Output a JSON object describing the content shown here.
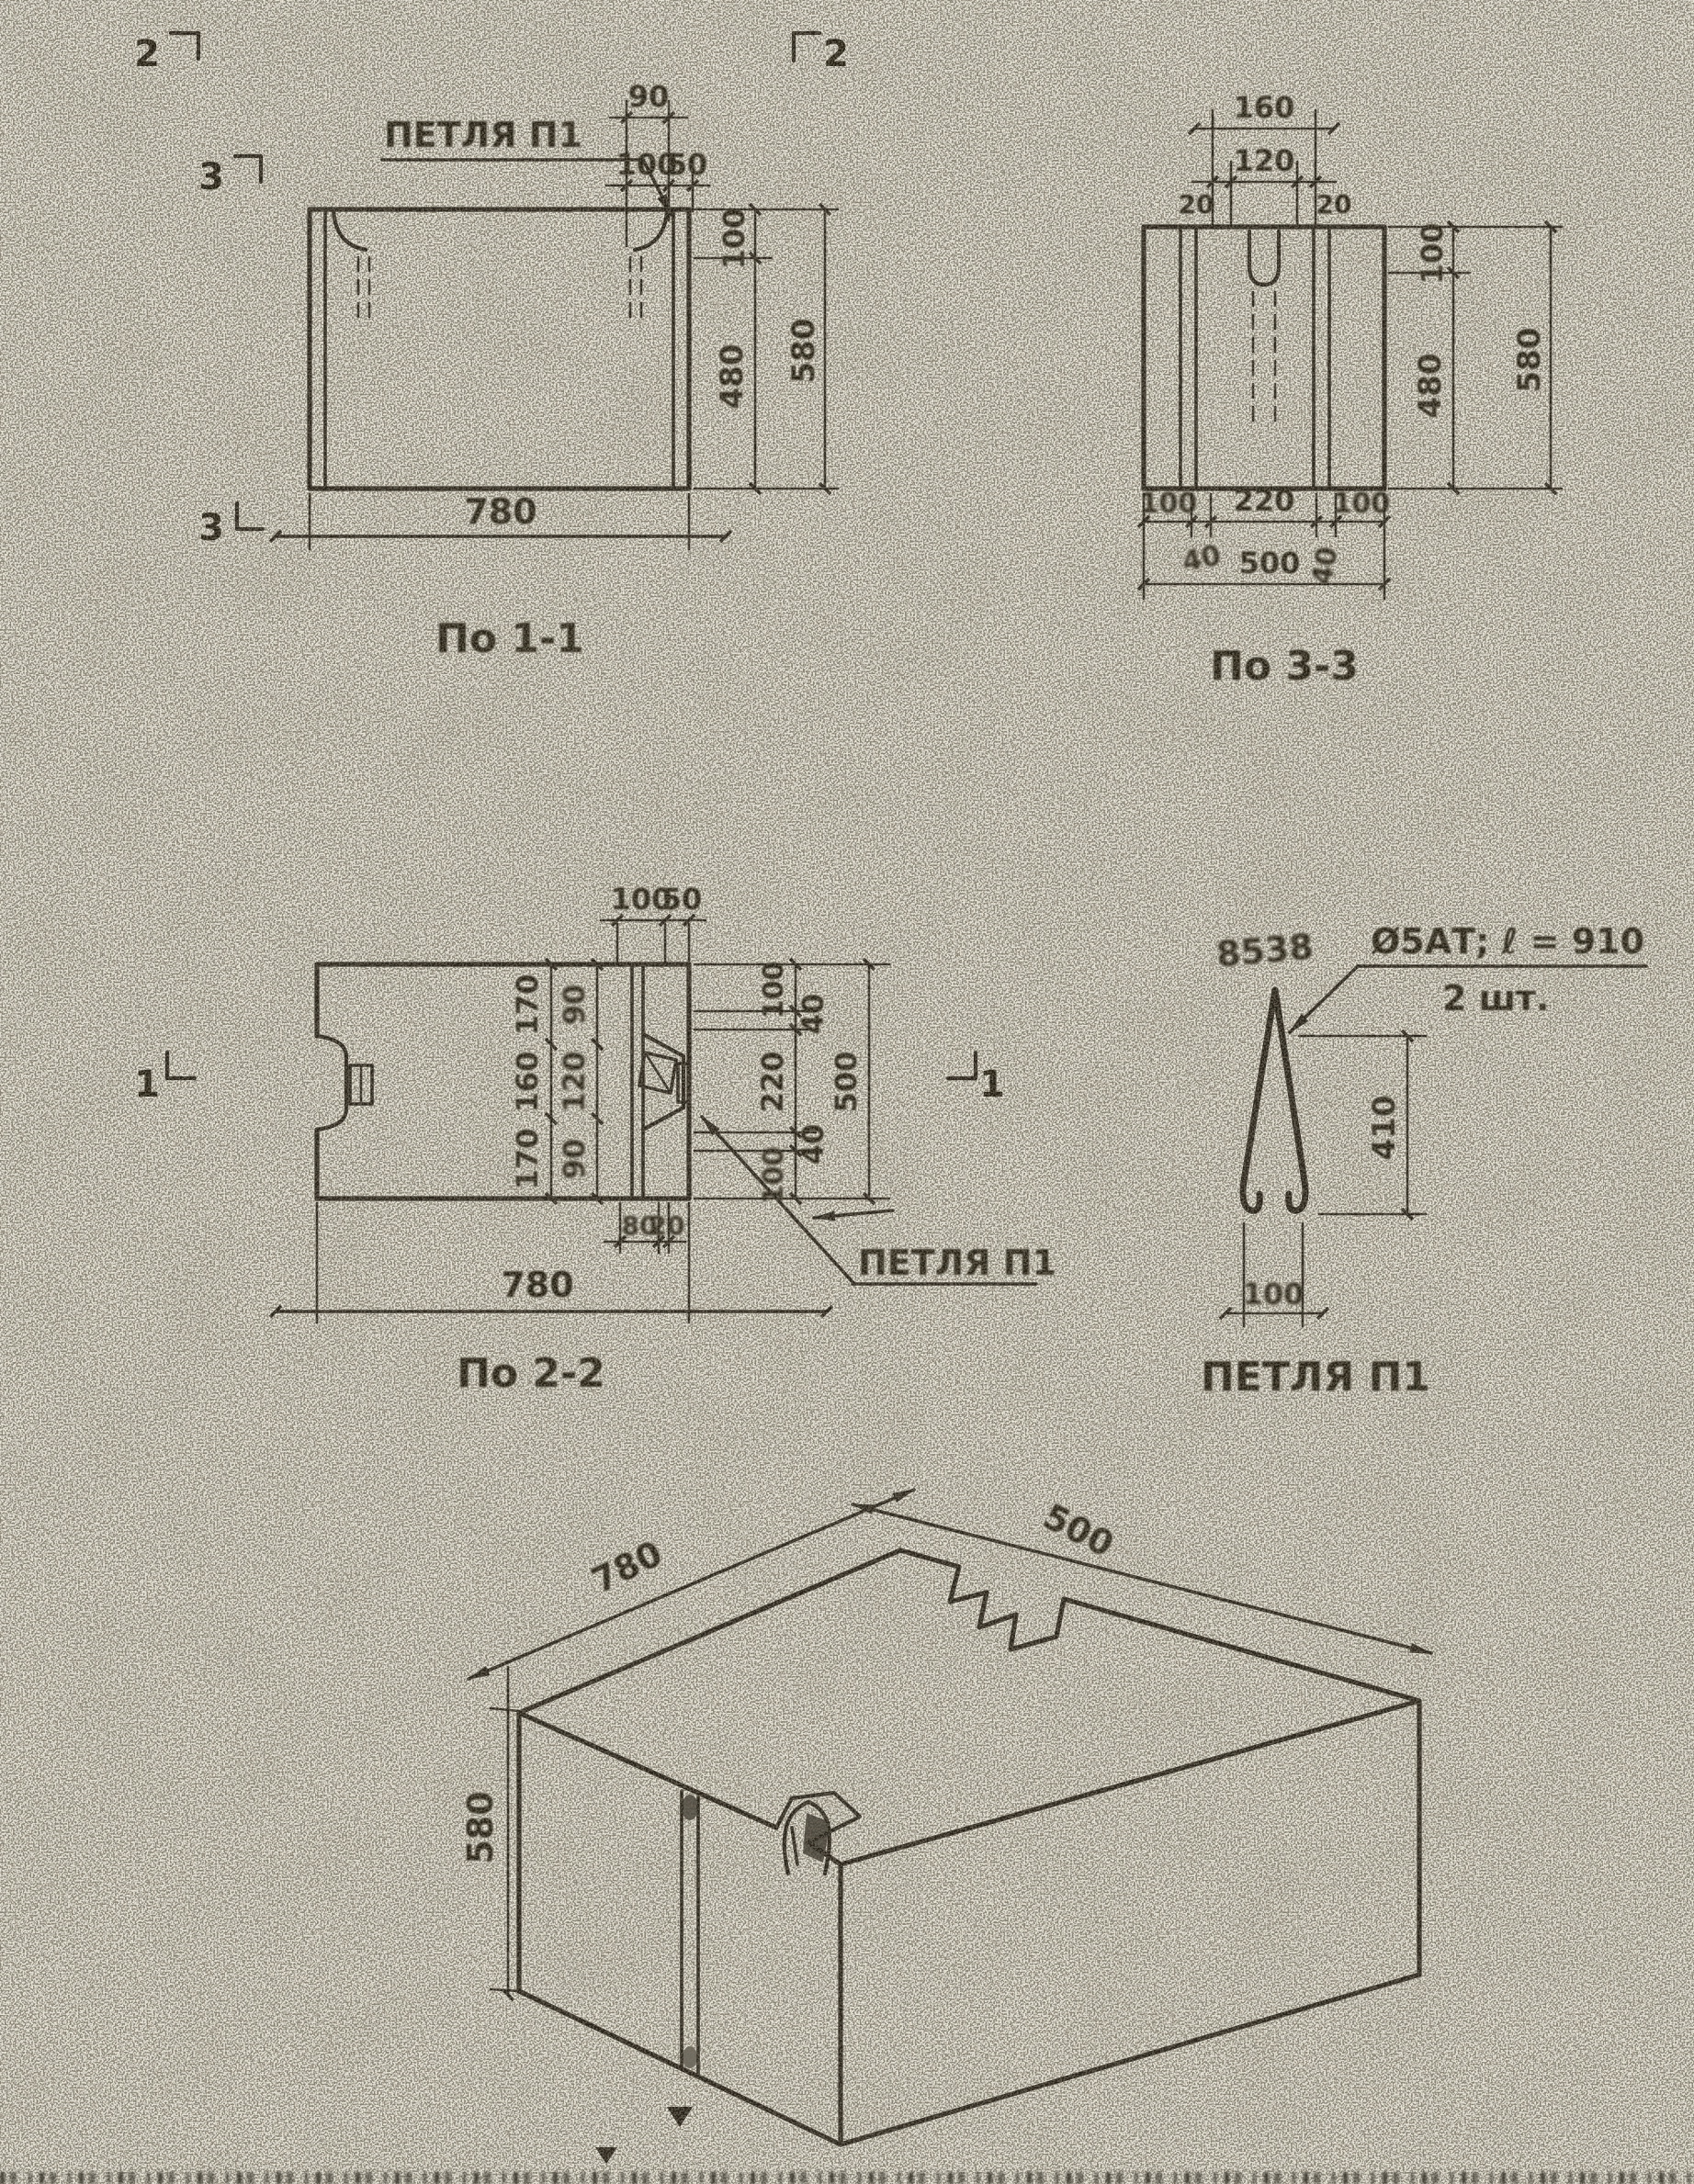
{
  "markers": {
    "sec2_left": "2",
    "sec2_right": "2",
    "sec3_top": "3",
    "sec3_bottom": "3",
    "sec1_left": "1",
    "sec1_right": "1"
  },
  "view11": {
    "caption": "По 1-1",
    "loop_label": "ПЕТЛЯ П1",
    "dims": {
      "top90": "90",
      "top100": "100",
      "top50": "50",
      "right100": "100",
      "right480": "480",
      "right580": "580",
      "bottom780": "780"
    }
  },
  "view33": {
    "caption": "По 3-3",
    "dims": {
      "top160": "160",
      "top20l": "20",
      "top120": "120",
      "top20r": "20",
      "right100": "100",
      "right480": "480",
      "right580": "580",
      "bot100l": "100",
      "bot40l": "40",
      "bot220": "220",
      "bot40r": "40",
      "bot100r": "100",
      "bot500": "500"
    }
  },
  "view22": {
    "caption": "По 2-2",
    "loop_label": "ПЕТЛЯ П1",
    "dims": {
      "top100": "100",
      "top50": "50",
      "colA": [
        "170",
        "160",
        "170"
      ],
      "colB": [
        "90",
        "120",
        "90"
      ],
      "right": [
        "100",
        "40",
        "220",
        "40",
        "100"
      ],
      "right_total": "500",
      "bot80": "80",
      "bot20": "20",
      "bottom780": "780"
    }
  },
  "loop": {
    "title": "ПЕТЛЯ П1",
    "note_mark": "8538",
    "spec": "Ø5АТ; ℓ = 910",
    "qty": "2 шт.",
    "dim_height": "410",
    "dim_width": "100"
  },
  "iso": {
    "dim_length": "780",
    "dim_depth": "500",
    "dim_height": "580"
  }
}
